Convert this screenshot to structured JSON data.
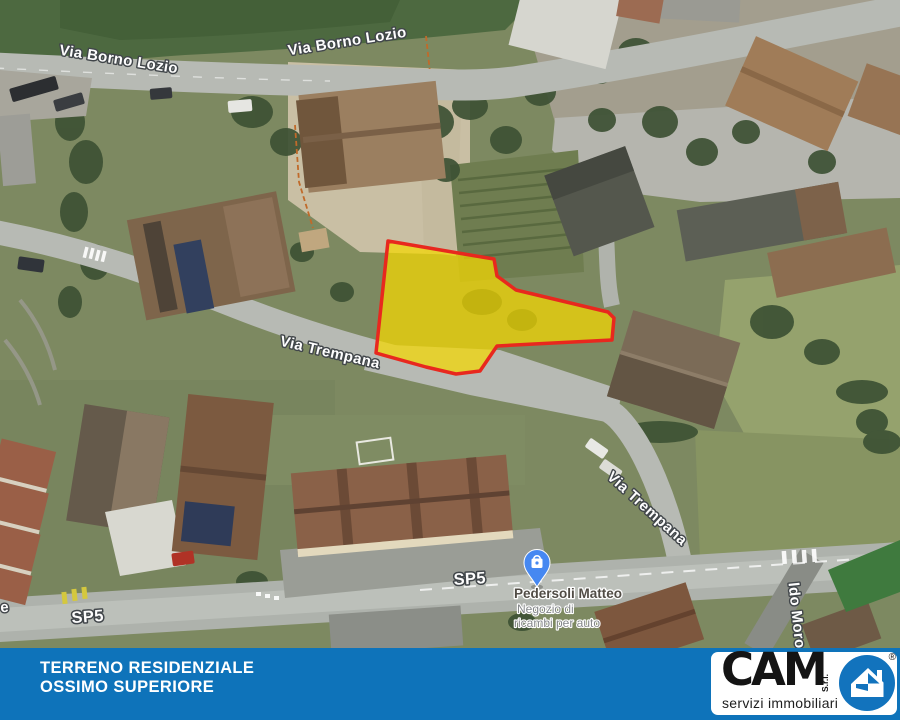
{
  "map": {
    "street_labels": [
      {
        "text": "Via Borno Lozio"
      },
      {
        "text": "Via Borno Lozio"
      },
      {
        "text": "Via Trempana"
      },
      {
        "text": "Via Trempana"
      },
      {
        "text": "SP5"
      },
      {
        "text": "SP5"
      },
      {
        "text": "ldo Moro"
      },
      {
        "text": "e"
      }
    ],
    "poi": {
      "name": "Pedersoli Matteo",
      "description_line1": "Negozio di",
      "description_line2": "ricambi per auto",
      "icon": "shopping-bag-pin-icon",
      "pin_color": "#4688f1"
    },
    "parcel": {
      "points": "388,241 464,254 494,259 497,276 516,290 608,312 614,318 612,340 534,344 497,346 480,371 456,374 426,367 376,353",
      "fill": "#f5d800",
      "stroke": "#e8281e"
    }
  },
  "banner": {
    "line1": "TERRENO RESIDENZIALE",
    "line2": "OSSIMO SUPERIORE",
    "background": "#0e73ba"
  },
  "logo": {
    "brand": "CAM",
    "suffix": "S.r.l.",
    "tagline": "servizi immobiliari",
    "registered_mark": "®",
    "icon": "house-icon",
    "circle_color": "#1273bd"
  }
}
